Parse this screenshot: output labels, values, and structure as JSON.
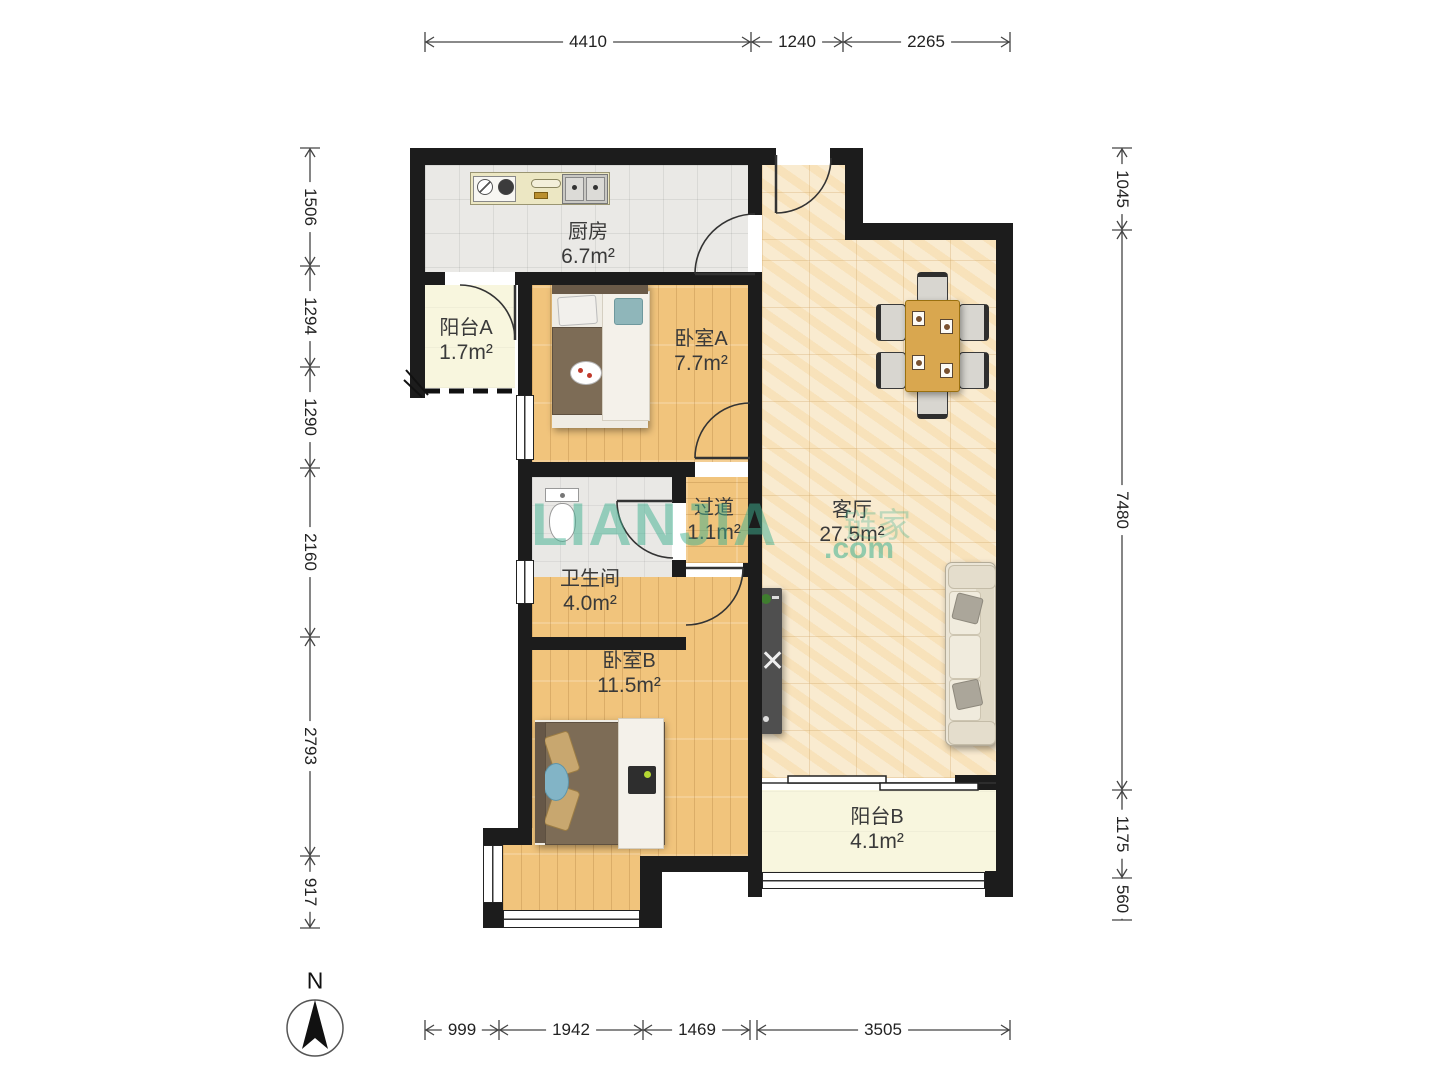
{
  "plan": {
    "rooms": {
      "kitchen": {
        "name": "厨房",
        "area": "6.7m²"
      },
      "balcony_a": {
        "name": "阳台A",
        "area": "1.7m²"
      },
      "bedroom_a": {
        "name": "卧室A",
        "area": "7.7m²"
      },
      "living": {
        "name": "客厅",
        "area": "27.5m²"
      },
      "hallway": {
        "name": "过道",
        "area": "1.1m²"
      },
      "bathroom": {
        "name": "卫生间",
        "area": "4.0m²"
      },
      "bedroom_b": {
        "name": "卧室B",
        "area": "11.5m²"
      },
      "balcony_b": {
        "name": "阳台B",
        "area": "4.1m²"
      }
    },
    "dims": {
      "top": [
        "4410",
        "1240",
        "2265"
      ],
      "left": [
        "1506",
        "1294",
        "1290",
        "2160",
        "2793",
        "917"
      ],
      "right": [
        "1045",
        "7480",
        "1175",
        "560"
      ],
      "bottom_left": [
        "999",
        "1942",
        "1469"
      ],
      "bottom_right": [
        "3505"
      ]
    },
    "compass": {
      "label": "N"
    },
    "watermark": {
      "brand": "LIANJIA",
      "tld": ".com",
      "cn": "链家"
    },
    "colors": {
      "watermark": "#3eb090",
      "wall": "#1c1c1c",
      "wood_floor": "#f1c47c",
      "living_floor": "#f9ead0",
      "tile_floor": "#eae9e6",
      "balcony_floor": "#f8f6de"
    }
  }
}
